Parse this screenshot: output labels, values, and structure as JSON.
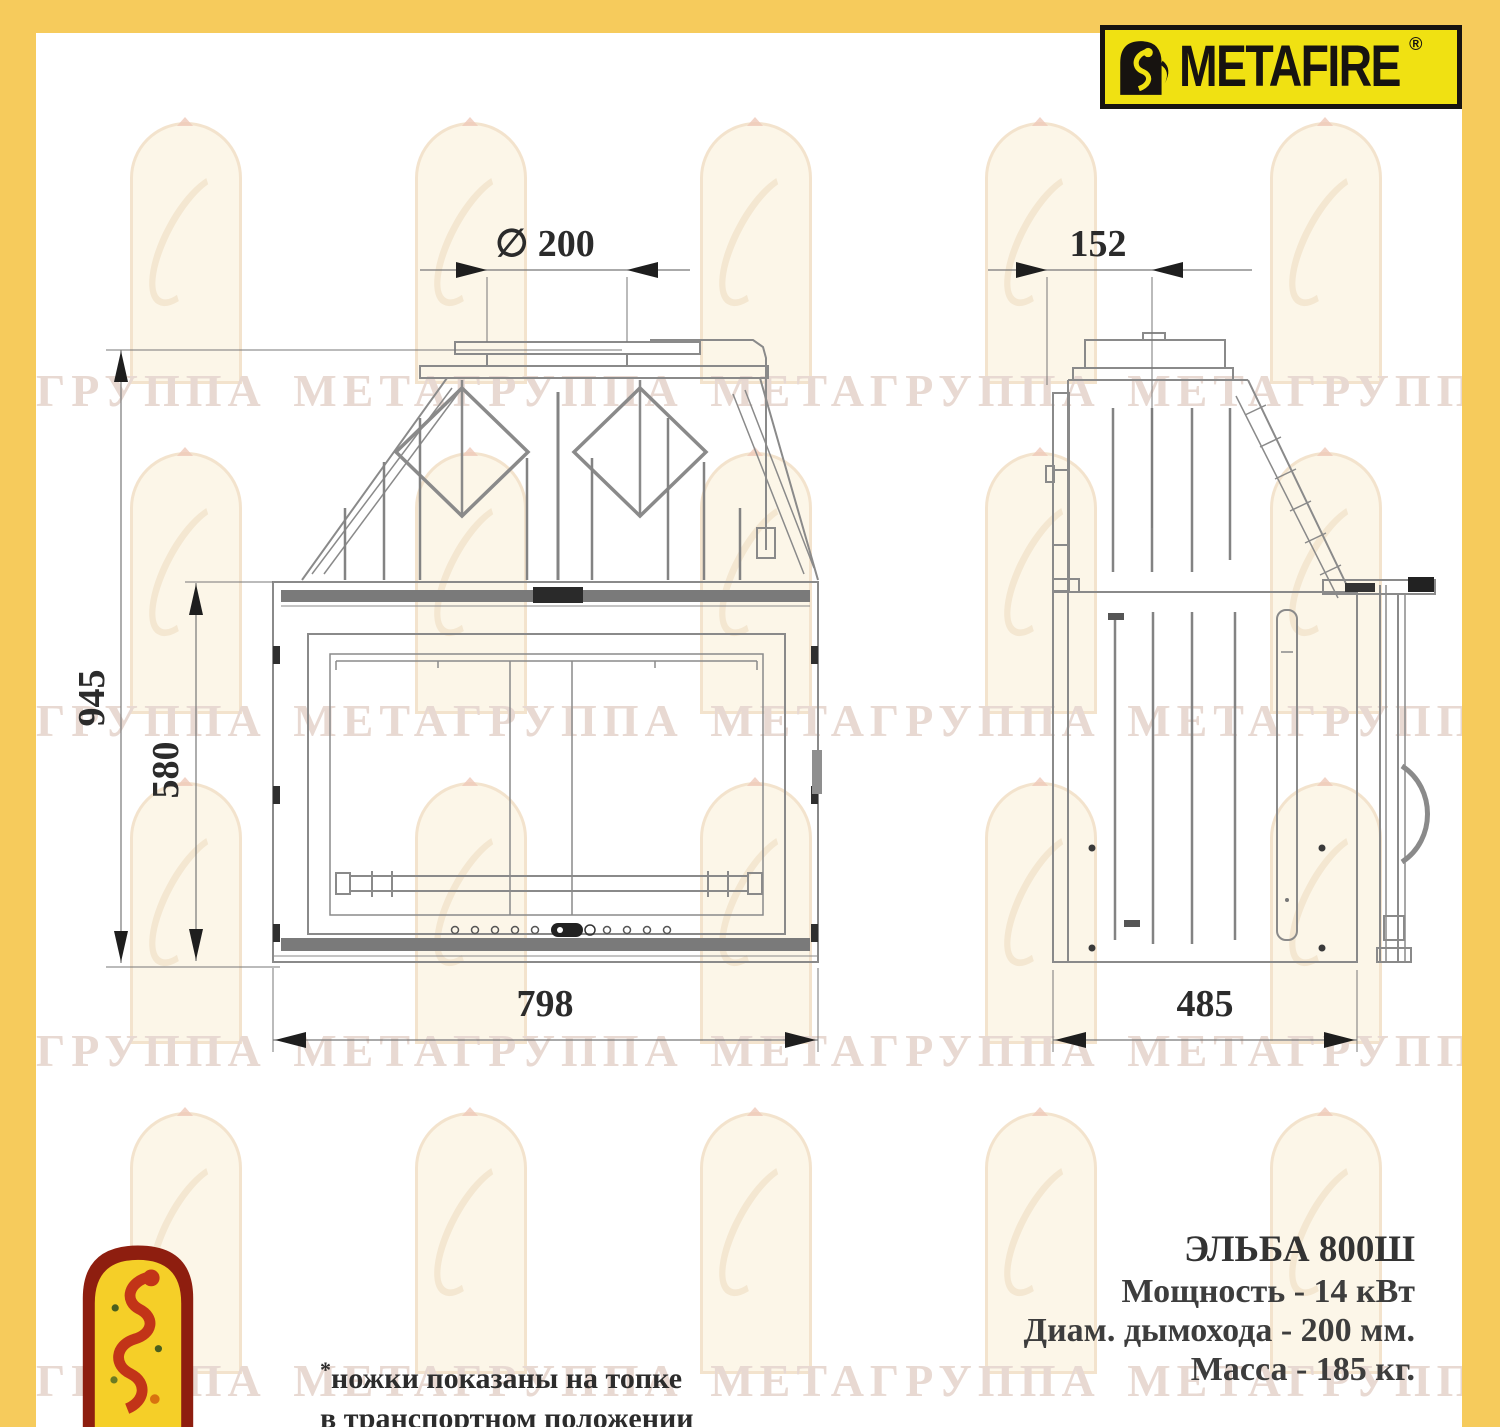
{
  "brand": {
    "name": "METAFIRE",
    "registered": "®"
  },
  "watermark": {
    "row_text": "ГРУППА МЕТАГРУППА МЕТАГРУППА МЕТАГРУППА МЕТА"
  },
  "drawing": {
    "views": {
      "front": "вид спереди",
      "side": "вид сбоку"
    },
    "dimensions": {
      "flue_diameter_front": "∅ 200",
      "flue_offset_side": "152",
      "total_height": "945",
      "door_height": "580",
      "front_width": "798",
      "side_depth": "485"
    }
  },
  "specs": {
    "model": "ЭЛЬБА 800Ш",
    "power": "Мощность - 14 кВт",
    "flue": "Диам. дымохода - 200 мм.",
    "mass": "Масса - 185 кг."
  },
  "footnote": {
    "star": "*",
    "line1": "ножки показаны на топке",
    "line2": "в транспортном положении"
  },
  "colors": {
    "border_yellow": "#f6cb5c",
    "logo_yellow": "#f0e112",
    "logo_black": "#171310",
    "watermark_text": "#e8d9d2",
    "line_gray": "#8a8a8a",
    "dim_dark": "#2b2b2b",
    "badge_red": "#8e1e0f",
    "badge_yellow": "#f5cf28",
    "figure_red": "#c23418"
  }
}
